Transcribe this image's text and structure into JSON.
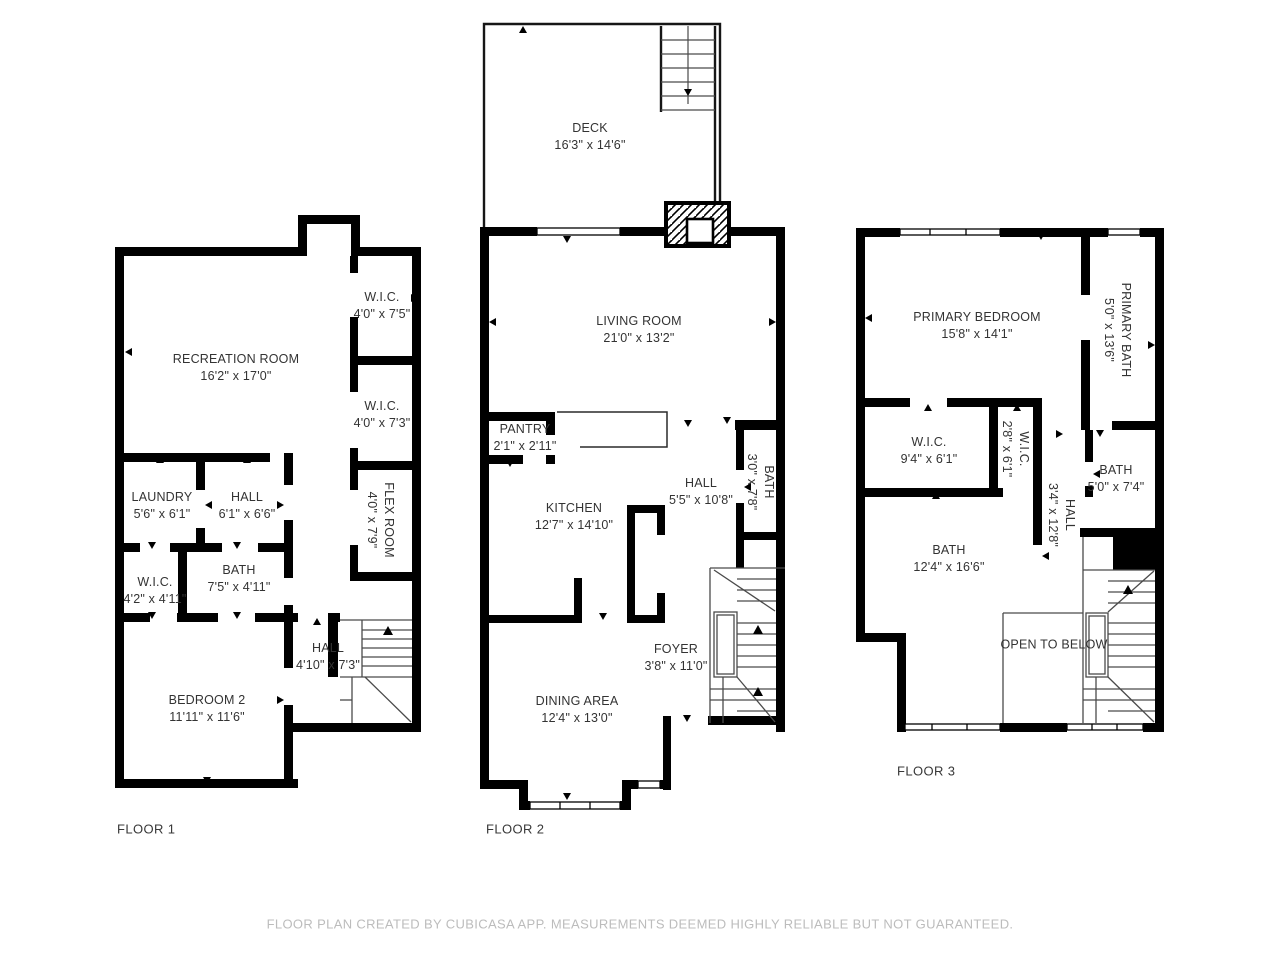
{
  "footer": {
    "disclaimer": "FLOOR PLAN CREATED BY CUBICASA APP. MEASUREMENTS DEEMED HIGHLY RELIABLE BUT NOT GUARANTEED."
  },
  "colors": {
    "wall": "#000000",
    "label_text": "#333333",
    "stair_line": "#4a4a4a",
    "footer_text": "#bcbcbc",
    "background": "#ffffff"
  },
  "floors": [
    {
      "label": "FLOOR 1",
      "rooms": [
        {
          "name": "RECREATION ROOM",
          "dims": "16'2\" x 17'0\""
        },
        {
          "name": "W.I.C.",
          "dims": "4'0\" x 7'5\""
        },
        {
          "name": "W.I.C.",
          "dims": "4'0\" x 7'3\""
        },
        {
          "name": "FLEX ROOM",
          "dims": "4'0\" x 7'9\""
        },
        {
          "name": "LAUNDRY",
          "dims": "5'6\" x 6'1\""
        },
        {
          "name": "HALL",
          "dims": "6'1\" x 6'6\""
        },
        {
          "name": "W.I.C.",
          "dims": "4'2\" x 4'11\""
        },
        {
          "name": "BATH",
          "dims": "7'5\" x 4'11\""
        },
        {
          "name": "HALL",
          "dims": "4'10\" x 7'3\""
        },
        {
          "name": "BEDROOM 2",
          "dims": "11'11\" x 11'6\""
        }
      ]
    },
    {
      "label": "FLOOR 2",
      "rooms": [
        {
          "name": "DECK",
          "dims": "16'3\" x 14'6\""
        },
        {
          "name": "LIVING ROOM",
          "dims": "21'0\" x 13'2\""
        },
        {
          "name": "PANTRY",
          "dims": "2'1\" x 2'11\""
        },
        {
          "name": "KITCHEN",
          "dims": "12'7\" x 14'10\""
        },
        {
          "name": "HALL",
          "dims": "5'5\" x 10'8\""
        },
        {
          "name": "BATH",
          "dims": "3'0\" x 7'8\""
        },
        {
          "name": "FOYER",
          "dims": "3'8\" x 11'0\""
        },
        {
          "name": "DINING AREA",
          "dims": "12'4\" x 13'0\""
        }
      ]
    },
    {
      "label": "FLOOR 3",
      "rooms": [
        {
          "name": "PRIMARY BEDROOM",
          "dims": "15'8\" x 14'1\""
        },
        {
          "name": "PRIMARY BATH",
          "dims": "5'0\" x 13'6\""
        },
        {
          "name": "W.I.C.",
          "dims": "9'4\" x 6'1\""
        },
        {
          "name": "W.I.C.",
          "dims": "2'8\" x 6'1\""
        },
        {
          "name": "HALL",
          "dims": "3'4\" x 12'8\""
        },
        {
          "name": "BATH",
          "dims": "5'0\" x 7'4\""
        },
        {
          "name": "BATH",
          "dims": "12'4\" x 16'6\""
        },
        {
          "name": "OPEN TO BELOW",
          "dims": ""
        }
      ]
    }
  ]
}
